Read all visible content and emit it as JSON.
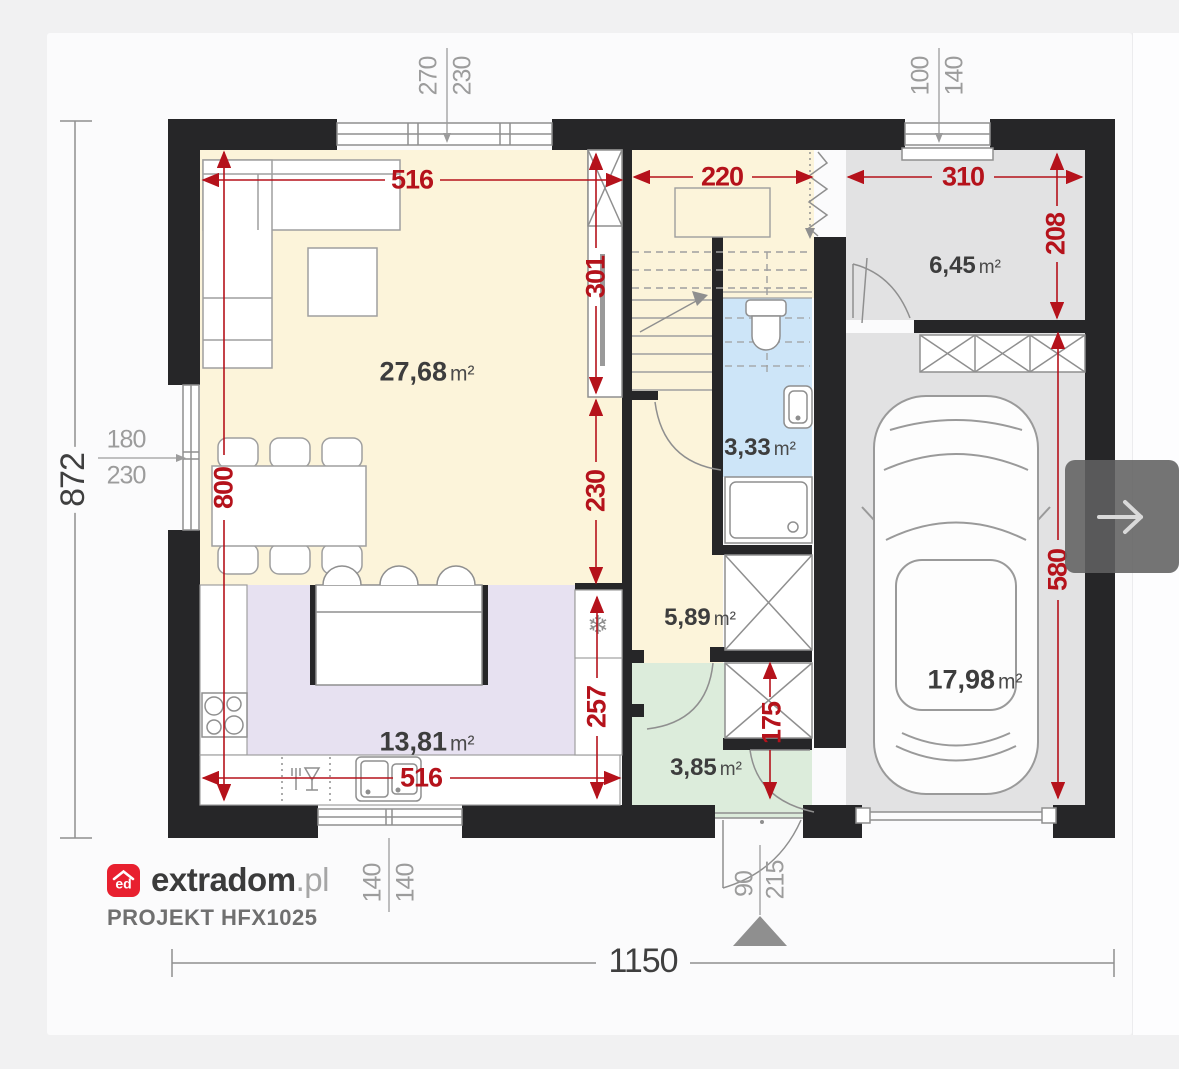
{
  "branding": {
    "logo_monogram": "ed",
    "brand_name": "extradom",
    "brand_tld": ".pl",
    "project_code": "PROJEKT HFX1025"
  },
  "rooms": {
    "living": {
      "value": "27,68",
      "unit": "m²"
    },
    "kitchen": {
      "value": "13,81",
      "unit": "m²"
    },
    "bathroom": {
      "value": "3,33",
      "unit": "m²"
    },
    "hall": {
      "value": "5,89",
      "unit": "m²"
    },
    "entry": {
      "value": "3,85",
      "unit": "m²"
    },
    "utility": {
      "value": "6,45",
      "unit": "m²"
    },
    "garage": {
      "value": "17,98",
      "unit": "m²"
    }
  },
  "dims": {
    "red": {
      "living_width": "516",
      "living_depth": "800",
      "stair_wall": "301",
      "stair_width": "220",
      "utility_width": "310",
      "utility_depth": "208",
      "hall_depth": "230",
      "kitchen_depth": "257",
      "kitchen_width": "516",
      "entry_depth": "175",
      "garage_depth": "580"
    },
    "gray": {
      "top_window_w": "270",
      "top_window_h": "230",
      "utility_window_w": "100",
      "utility_window_h": "140",
      "left_window_w": "180",
      "left_window_h": "230",
      "kitchen_window_w": "140",
      "kitchen_window_h": "140",
      "entry_door_w": "90",
      "entry_door_h": "215",
      "total_width": "1150",
      "total_depth": "872"
    }
  },
  "icons": {
    "snowflake_glyph": "❄",
    "next_button_icon": "arrow-right-icon",
    "entrance_marker": "entrance-arrow-icon"
  },
  "colors": {
    "dimension_red": "#b5121b",
    "wall_black": "#262628",
    "living_cream": "#fcf4da",
    "kitchen_lavender": "#e7e1f1",
    "bathroom_blue": "#cde5f8",
    "entry_green": "#dcecdb",
    "garage_gray": "#e2e2e3",
    "logo_red": "#e8202f"
  }
}
